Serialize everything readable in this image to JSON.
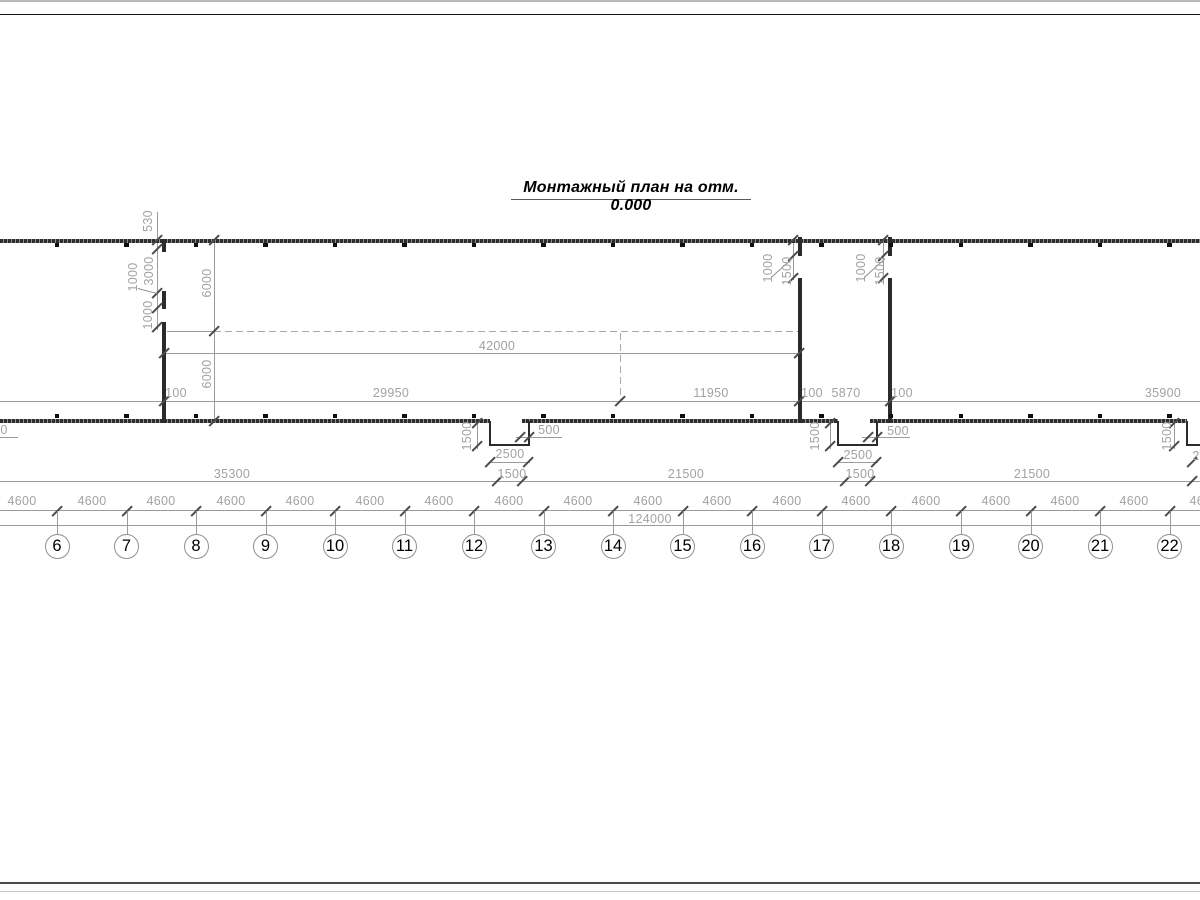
{
  "title": {
    "text": "Монтажный план на отм. 0.000"
  },
  "axes": {
    "circles": [
      {
        "n": "5",
        "x": -12.5
      },
      {
        "n": "6",
        "x": 57
      },
      {
        "n": "7",
        "x": 126.5
      },
      {
        "n": "8",
        "x": 196
      },
      {
        "n": "9",
        "x": 265.5
      },
      {
        "n": "10",
        "x": 335
      },
      {
        "n": "11",
        "x": 404.5
      },
      {
        "n": "12",
        "x": 474
      },
      {
        "n": "13",
        "x": 543.5
      },
      {
        "n": "14",
        "x": 613
      },
      {
        "n": "15",
        "x": 682.5
      },
      {
        "n": "16",
        "x": 752
      },
      {
        "n": "17",
        "x": 821.5
      },
      {
        "n": "18",
        "x": 891
      },
      {
        "n": "19",
        "x": 961
      },
      {
        "n": "20",
        "x": 1030.5
      },
      {
        "n": "21",
        "x": 1100
      },
      {
        "n": "22",
        "x": 1169.5
      }
    ],
    "cy": 546,
    "r": 12.5
  },
  "spacing_row": {
    "label": "4600",
    "y": 501,
    "line_y": 510,
    "xs": [
      22,
      92,
      161,
      231,
      300,
      370,
      439,
      509,
      578,
      648,
      717,
      787,
      856,
      926,
      996,
      1065,
      1134,
      1204
    ]
  },
  "overall_dim": {
    "text": "124000",
    "x": 650,
    "y": 519,
    "line_y": 525
  },
  "dim_labels": [
    {
      "t": "42000",
      "x": 497,
      "y": 346
    },
    {
      "t": "100",
      "x": 176,
      "y": 393
    },
    {
      "t": "29950",
      "x": 391,
      "y": 393
    },
    {
      "t": "11950",
      "x": 711,
      "y": 393
    },
    {
      "t": "100",
      "x": 812,
      "y": 393
    },
    {
      "t": "5870",
      "x": 846,
      "y": 393
    },
    {
      "t": "100",
      "x": 902,
      "y": 393
    },
    {
      "t": "35900",
      "x": 1163,
      "y": 393
    },
    {
      "t": "500",
      "x": 549,
      "y": 430
    },
    {
      "t": "2500",
      "x": 510,
      "y": 454
    },
    {
      "t": "1500",
      "x": 512,
      "y": 474
    },
    {
      "t": "500",
      "x": 898,
      "y": 431
    },
    {
      "t": "2500",
      "x": 858,
      "y": 455
    },
    {
      "t": "1500",
      "x": 860,
      "y": 474
    },
    {
      "t": "35300",
      "x": 232,
      "y": 474
    },
    {
      "t": "21500",
      "x": 686,
      "y": 474
    },
    {
      "t": "21500",
      "x": 1032,
      "y": 474
    },
    {
      "t": "0",
      "x": 4,
      "y": 430
    },
    {
      "t": "2",
      "x": 1196,
      "y": 456
    }
  ],
  "dim_labels_rotated": [
    {
      "t": "530",
      "x": 148,
      "y": 221
    },
    {
      "t": "1000",
      "x": 133,
      "y": 277
    },
    {
      "t": "3000",
      "x": 149,
      "y": 271
    },
    {
      "t": "1000",
      "x": 148,
      "y": 315
    },
    {
      "t": "6000",
      "x": 207,
      "y": 283
    },
    {
      "t": "6000",
      "x": 207,
      "y": 374
    },
    {
      "t": "1000",
      "x": 768,
      "y": 268
    },
    {
      "t": "1500",
      "x": 787,
      "y": 271
    },
    {
      "t": "1000",
      "x": 861,
      "y": 268
    },
    {
      "t": "1500",
      "x": 880,
      "y": 271
    },
    {
      "t": "1500",
      "x": 467,
      "y": 436
    },
    {
      "t": "1500",
      "x": 815,
      "y": 436
    },
    {
      "t": "1500",
      "x": 1167,
      "y": 436
    }
  ],
  "geometry": {
    "walls_textured": [
      [
        0,
        238.5,
        1200,
        4
      ],
      [
        0,
        418.5,
        490,
        4.5
      ],
      [
        522,
        418.5,
        316,
        4.5
      ],
      [
        870,
        418.5,
        317,
        4.5
      ]
    ],
    "walls_solid": [
      [
        162,
        239,
        4,
        13
      ],
      [
        162,
        291,
        4,
        18
      ],
      [
        162,
        322,
        4,
        101
      ],
      [
        798,
        237,
        4,
        19
      ],
      [
        798,
        278,
        4,
        145
      ],
      [
        888,
        237,
        4,
        19
      ],
      [
        888,
        278,
        4,
        145
      ]
    ],
    "notch_lines": [
      [
        489,
        421,
        2,
        25
      ],
      [
        528,
        421,
        2,
        25
      ],
      [
        489,
        444,
        41,
        2
      ],
      [
        837,
        421,
        2,
        25
      ],
      [
        876,
        421,
        2,
        25
      ],
      [
        837,
        444,
        41,
        2
      ],
      [
        1186,
        421,
        2,
        25
      ],
      [
        1186,
        444,
        14,
        2
      ]
    ],
    "thin_lines": [
      [
        214,
        240,
        1,
        183
      ],
      [
        164,
        352.5,
        636,
        1
      ],
      [
        0,
        400.5,
        1200,
        1
      ],
      [
        0,
        481,
        1200,
        1
      ],
      [
        0,
        510,
        1200,
        1
      ],
      [
        0,
        525,
        1200,
        1
      ],
      [
        477,
        421,
        1,
        28
      ],
      [
        516,
        437,
        46,
        1
      ],
      [
        489,
        462,
        41,
        1
      ],
      [
        830,
        421,
        1,
        28
      ],
      [
        862,
        437,
        48,
        1
      ],
      [
        837,
        462,
        41,
        1
      ],
      [
        1174,
        421,
        1,
        28
      ],
      [
        157,
        212,
        1,
        118
      ],
      [
        793,
        238,
        1,
        42
      ],
      [
        883,
        238,
        1,
        42
      ],
      [
        167,
        330.5,
        47,
        1
      ],
      [
        0,
        437,
        18,
        1
      ]
    ],
    "dashed_h": [
      [
        214,
        330.5,
        585
      ]
    ],
    "dashed_v": [
      [
        620,
        333,
        69
      ]
    ],
    "ticks": [
      [
        164,
        400.5
      ],
      [
        620,
        400.5
      ],
      [
        799,
        400.5
      ],
      [
        890,
        400.5
      ],
      [
        214,
        240
      ],
      [
        214,
        331
      ],
      [
        214,
        421
      ],
      [
        164,
        352.5
      ],
      [
        799,
        352.5
      ],
      [
        157,
        240
      ],
      [
        157,
        249
      ],
      [
        157,
        293
      ],
      [
        157,
        308
      ],
      [
        157,
        327
      ],
      [
        793,
        240
      ],
      [
        793,
        256
      ],
      [
        793,
        278
      ],
      [
        883,
        240
      ],
      [
        883,
        256
      ],
      [
        883,
        278
      ],
      [
        477,
        423
      ],
      [
        477,
        446
      ],
      [
        520,
        437
      ],
      [
        529,
        437
      ],
      [
        490,
        462
      ],
      [
        528,
        462
      ],
      [
        497,
        481
      ],
      [
        522,
        481
      ],
      [
        830,
        423
      ],
      [
        830,
        446
      ],
      [
        868,
        437
      ],
      [
        877,
        437
      ],
      [
        838,
        462
      ],
      [
        876,
        462
      ],
      [
        845,
        481
      ],
      [
        870,
        481
      ],
      [
        1174,
        423
      ],
      [
        1174,
        446
      ],
      [
        1192,
        462
      ],
      [
        1192,
        481
      ]
    ],
    "leaders": [
      {
        "x": 138,
        "y": 288,
        "len": 20,
        "ang": 14.7
      },
      {
        "x": 771,
        "y": 277,
        "len": 28.3,
        "ang": -42.1
      },
      {
        "x": 864,
        "y": 277,
        "len": 28.3,
        "ang": -42.1
      }
    ],
    "column_marks": {
      "top_y": 242.5,
      "bottom_y": 413.8
    },
    "frame_lines": [
      {
        "y": 0,
        "h": 2,
        "c": "#b8b8b8"
      },
      {
        "y": 13.5,
        "h": 1.6,
        "c": "#161616"
      },
      {
        "y": 882,
        "h": 2.2,
        "c": "#4a4a4a"
      },
      {
        "y": 891,
        "h": 1.2,
        "c": "#c6c6c6"
      }
    ]
  }
}
